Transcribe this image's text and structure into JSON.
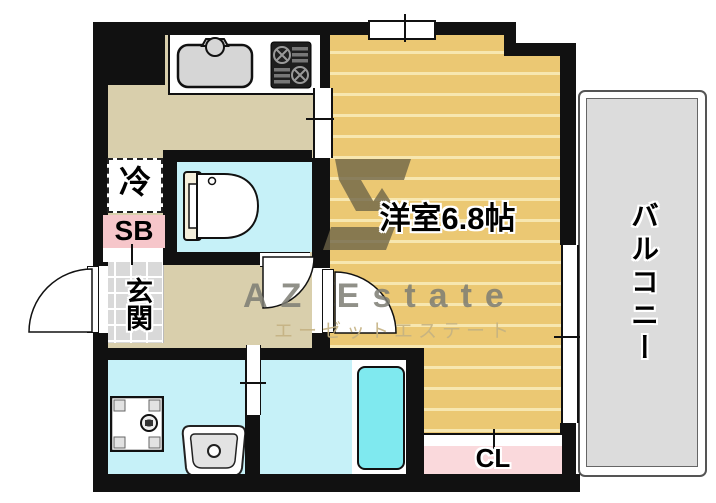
{
  "floorplan": {
    "labels": {
      "main_room": "洋室6.8帖",
      "balcony": "バルコニー",
      "entrance": "玄関",
      "closet": "CL",
      "shoe_box": "SB",
      "refrigerator": "冷"
    },
    "watermark": {
      "brand": "AZ Estate",
      "brand_kana": "エーゼットエステート"
    },
    "colors": {
      "wall": "#111111",
      "wood_floor": "#ebc873",
      "wood_floor_line": "#f7e7b0",
      "vinyl_floor": "#d9cfac",
      "wet_room_floor": "#c6f1f8",
      "bathtub": "#7fe9ef",
      "closet_fill": "#fad9dc",
      "shoe_box_fill": "#f6c6ca",
      "entrance_tile": "#d9d9d9",
      "balcony_fill": "#dcdcdc",
      "watermark_gray": "#7d7d74",
      "watermark_kana": "#c5b282",
      "watermark_logo": "#6c6347"
    },
    "fixture_icons": [
      "kitchen-sink-icon",
      "gas-stove-icon",
      "toilet-icon",
      "washing-machine-pan-icon",
      "washbasin-icon",
      "bathtub-icon"
    ]
  }
}
